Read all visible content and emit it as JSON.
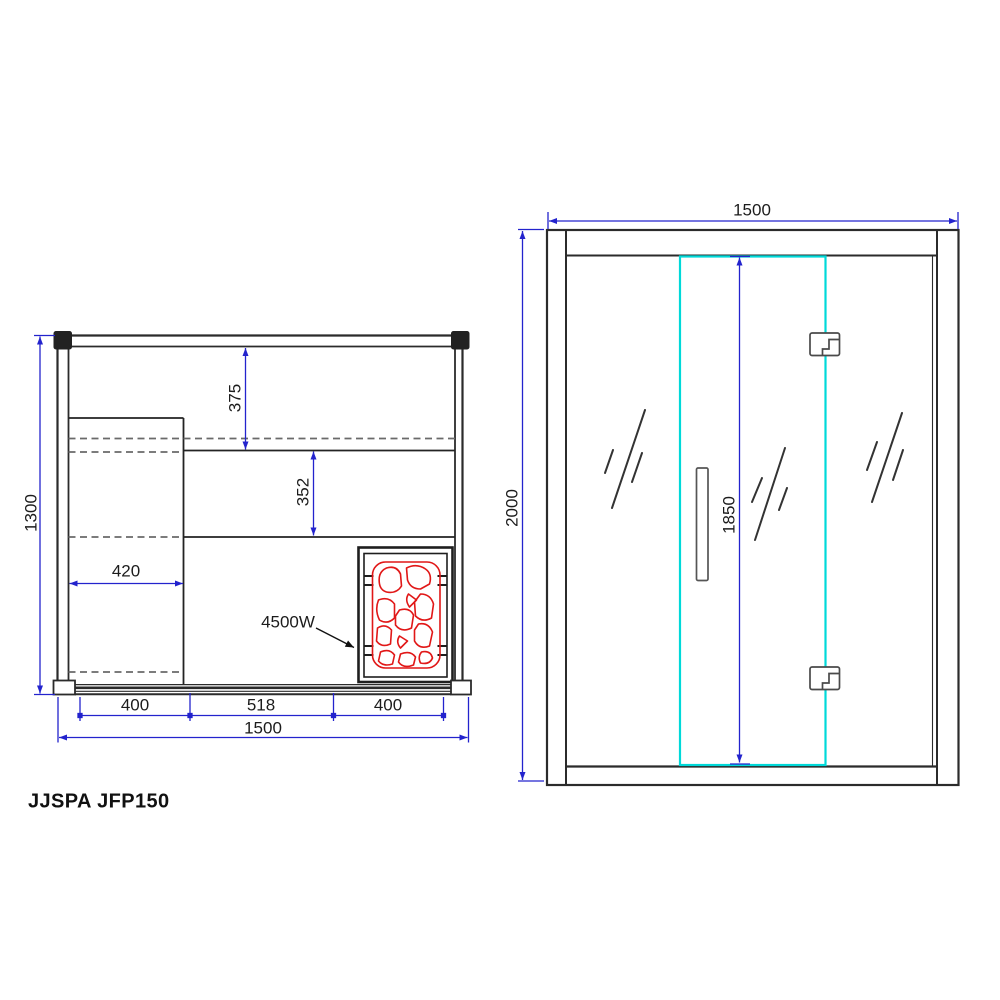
{
  "title": "JJSPA JFP150",
  "colors": {
    "dimension_blue": "#2323cd",
    "wall_black": "#2b2b2b",
    "heater_red": "#e11717",
    "door_cyan": "#00d9d9",
    "hidden_gray": "#6a6a6a"
  },
  "plan_view": {
    "label_depth": "1300",
    "label_back_bench_depth": "375",
    "label_mid_bench_depth": "352",
    "label_side_bench_width": "420",
    "label_front_left": "400",
    "label_front_center": "518",
    "label_front_right": "400",
    "label_width": "1500",
    "heater_power": "4500W"
  },
  "elevation_view": {
    "label_width": "1500",
    "label_height": "2000",
    "label_door_height": "1850"
  }
}
